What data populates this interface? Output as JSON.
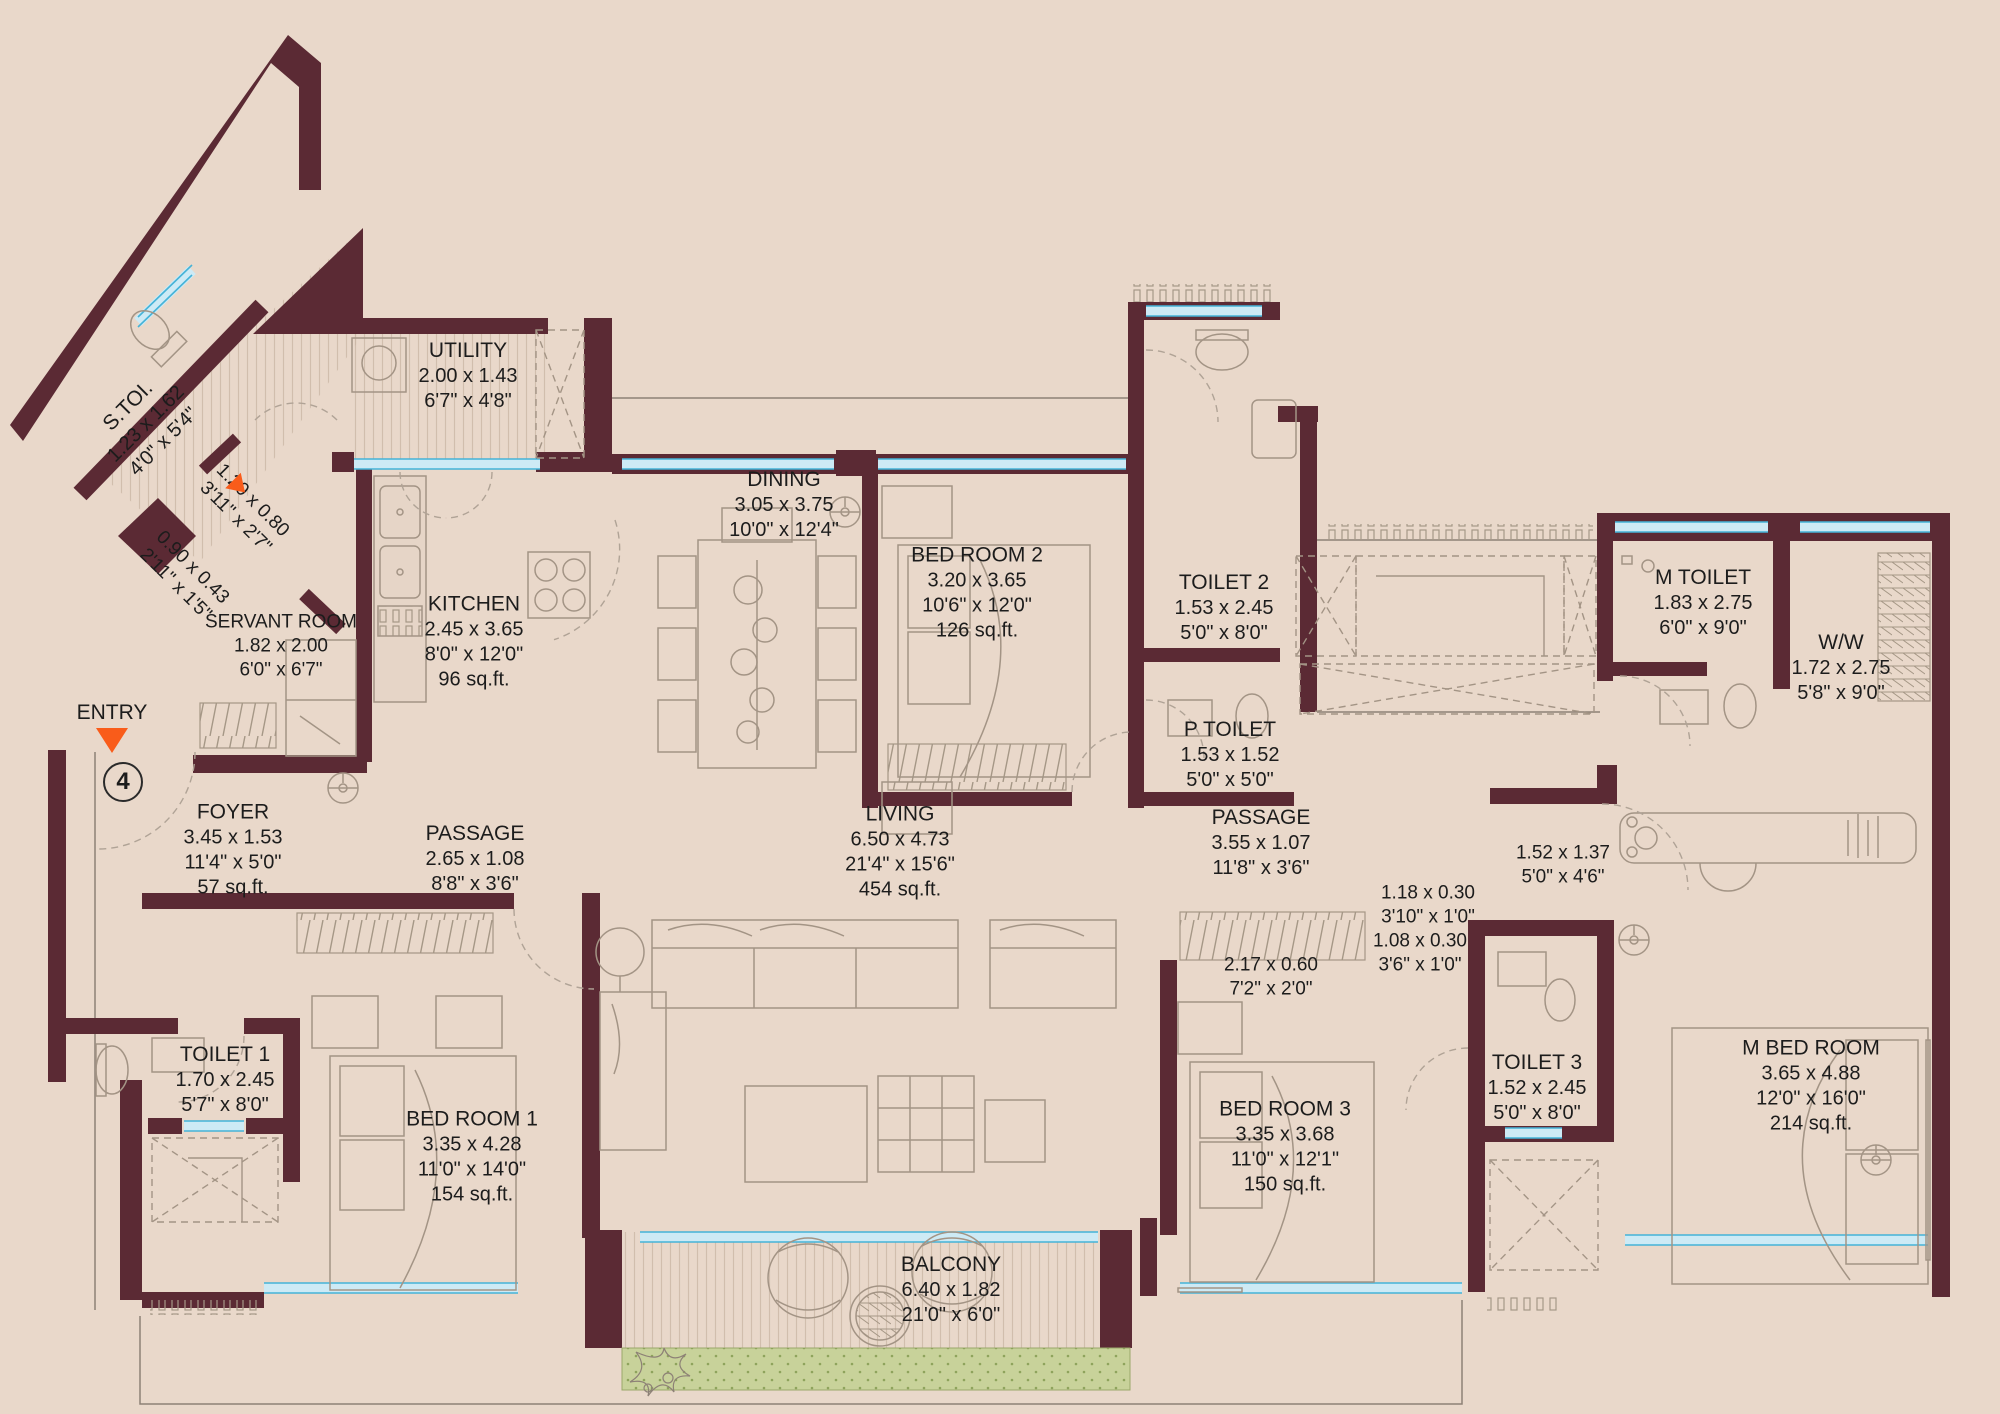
{
  "plan_name": "apartment-floor-plan",
  "colors": {
    "wall": "#5b2a34",
    "background": "#e9d8ca",
    "window": "#45b3d8",
    "planter": "#c8d29a",
    "entry_marker": "#f95c1a",
    "furniture_line": "#a39485"
  },
  "entry": {
    "label": "ENTRY",
    "unit_number": "4"
  },
  "labels": [
    {
      "id": "s-toi",
      "title": "S.TOI.",
      "metric": "1.23 x 1.62",
      "imperial": "4'0\" x 5'4\""
    },
    {
      "id": "dim-entry-1",
      "metric": "1.20 x 0.80",
      "imperial": "3'11\" x 2'7\""
    },
    {
      "id": "dim-entry-2",
      "metric": "0.90 x 0.43",
      "imperial": "2'11\" x 1'5\""
    },
    {
      "id": "utility",
      "title": "UTILITY",
      "metric": "2.00 x 1.43",
      "imperial": "6'7\" x 4'8\""
    },
    {
      "id": "servant-room",
      "title": "SERVANT ROOM",
      "metric": "1.82 x 2.00",
      "imperial": "6'0\" x 6'7\""
    },
    {
      "id": "kitchen",
      "title": "KITCHEN",
      "metric": "2.45 x 3.65",
      "imperial": "8'0\" x 12'0\"",
      "area": "96 sq.ft."
    },
    {
      "id": "dining",
      "title": "DINING",
      "metric": "3.05 x 3.75",
      "imperial": "10'0\" x 12'4\""
    },
    {
      "id": "bed-room-2",
      "title": "BED ROOM 2",
      "metric": "3.20 x 3.65",
      "imperial": "10'6\" x 12'0\"",
      "area": "126 sq.ft."
    },
    {
      "id": "toilet-2",
      "title": "TOILET 2",
      "metric": "1.53 x 2.45",
      "imperial": "5'0\" x 8'0\""
    },
    {
      "id": "p-toilet",
      "title": "P TOILET",
      "metric": "1.53 x 1.52",
      "imperial": "5'0\" x 5'0\""
    },
    {
      "id": "m-toilet",
      "title": "M TOILET",
      "metric": "1.83 x 2.75",
      "imperial": "6'0\" x 9'0\""
    },
    {
      "id": "ww",
      "title": "W/W",
      "metric": "1.72 x 2.75",
      "imperial": "5'8\" x 9'0\""
    },
    {
      "id": "foyer",
      "title": "FOYER",
      "metric": "3.45 x 1.53",
      "imperial": "11'4\" x 5'0\"",
      "area": "57 sq.ft."
    },
    {
      "id": "passage-left",
      "title": "PASSAGE",
      "metric": "2.65 x 1.08",
      "imperial": "8'8\" x 3'6\""
    },
    {
      "id": "living",
      "title": "LIVING",
      "metric": "6.50 x 4.73",
      "imperial": "21'4\" x 15'6\"",
      "area": "454 sq.ft."
    },
    {
      "id": "passage-right",
      "title": "PASSAGE",
      "metric": "3.55 x 1.07",
      "imperial": "11'8\" x 3'6\""
    },
    {
      "id": "dim-passage",
      "metric": "1.52 x 1.37",
      "imperial": "5'0\" x 4'6\""
    },
    {
      "id": "dim-ledge-1",
      "metric": "1.18 x 0.30",
      "imperial": "3'10\" x 1'0\""
    },
    {
      "id": "dim-ledge-2",
      "metric": "1.08 x 0.30",
      "imperial": "3'6\" x 1'0\""
    },
    {
      "id": "dim-wardrobe",
      "metric": "2.17 x 0.60",
      "imperial": "7'2\" x 2'0\""
    },
    {
      "id": "toilet-1",
      "title": "TOILET 1",
      "metric": "1.70 x 2.45",
      "imperial": "5'7\" x 8'0\""
    },
    {
      "id": "bed-room-1",
      "title": "BED ROOM 1",
      "metric": "3.35 x 4.28",
      "imperial": "11'0\" x 14'0\"",
      "area": "154 sq.ft."
    },
    {
      "id": "bed-room-3",
      "title": "BED ROOM 3",
      "metric": "3.35 x 3.68",
      "imperial": "11'0\" x 12'1\"",
      "area": "150 sq.ft."
    },
    {
      "id": "toilet-3",
      "title": "TOILET 3",
      "metric": "1.52 x 2.45",
      "imperial": "5'0\" x 8'0\""
    },
    {
      "id": "m-bed-room",
      "title": "M BED ROOM",
      "metric": "3.65 x 4.88",
      "imperial": "12'0\" x 16'0\"",
      "area": "214 sq.ft."
    },
    {
      "id": "balcony",
      "title": "BALCONY",
      "metric": "6.40 x 1.82",
      "imperial": "21'0\" x 6'0\""
    }
  ]
}
